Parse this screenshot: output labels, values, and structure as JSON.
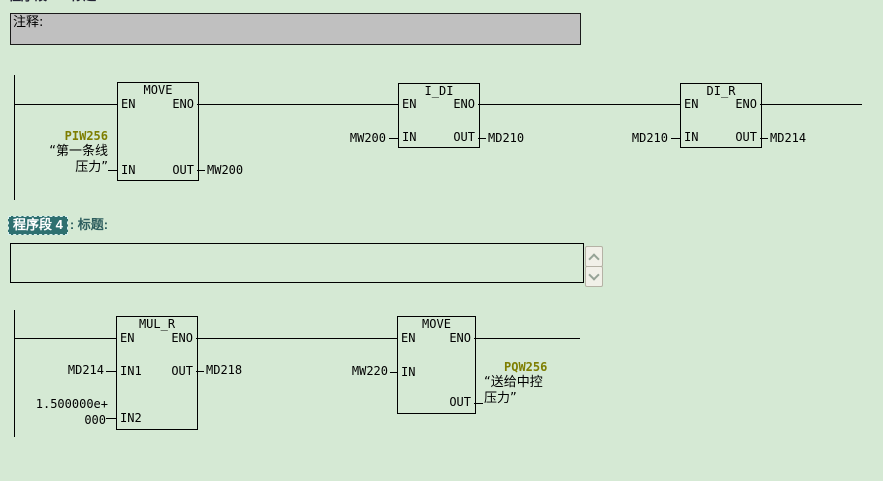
{
  "window": {
    "top_clipped_header": "程序段 3: 标题:",
    "comment_label": "注释:",
    "network_header": {
      "badge": "程序段 4",
      "suffix": ": 标题:"
    },
    "title_box_value": "",
    "colors": {
      "background": "#D5E9D4",
      "operand_olive": "#7E7E00",
      "selection_teal": "#2E7070",
      "comment_gray": "#C0C0C0"
    }
  },
  "net3": {
    "move": {
      "title": "MOVE",
      "pin_en": "EN",
      "pin_eno": "ENO",
      "pin_in": "IN",
      "pin_out": "OUT",
      "in_operand": "PIW256",
      "in_comment1": "“第一条线",
      "in_comment2": "压力”",
      "out_operand": "MW200"
    },
    "i_di": {
      "title": "I_DI",
      "pin_en": "EN",
      "pin_eno": "ENO",
      "pin_in": "IN",
      "pin_out": "OUT",
      "in_operand": "MW200",
      "out_operand": "MD210"
    },
    "di_r": {
      "title": "DI_R",
      "pin_en": "EN",
      "pin_eno": "ENO",
      "pin_in": "IN",
      "pin_out": "OUT",
      "in_operand": "MD210",
      "out_operand": "MD214"
    }
  },
  "net4": {
    "mul_r": {
      "title": "MUL_R",
      "pin_en": "EN",
      "pin_eno": "ENO",
      "pin_in1": "IN1",
      "pin_in2": "IN2",
      "pin_out": "OUT",
      "in1_operand": "MD214",
      "in2_value_line1": "1.500000e+",
      "in2_value_line2": "000",
      "out_operand": "MD218"
    },
    "move": {
      "title": "MOVE",
      "pin_en": "EN",
      "pin_eno": "ENO",
      "pin_in": "IN",
      "pin_out": "OUT",
      "in_operand": "MW220",
      "out_operand": "PQW256",
      "out_comment1": "“送给中控",
      "out_comment2": "压力”"
    }
  }
}
